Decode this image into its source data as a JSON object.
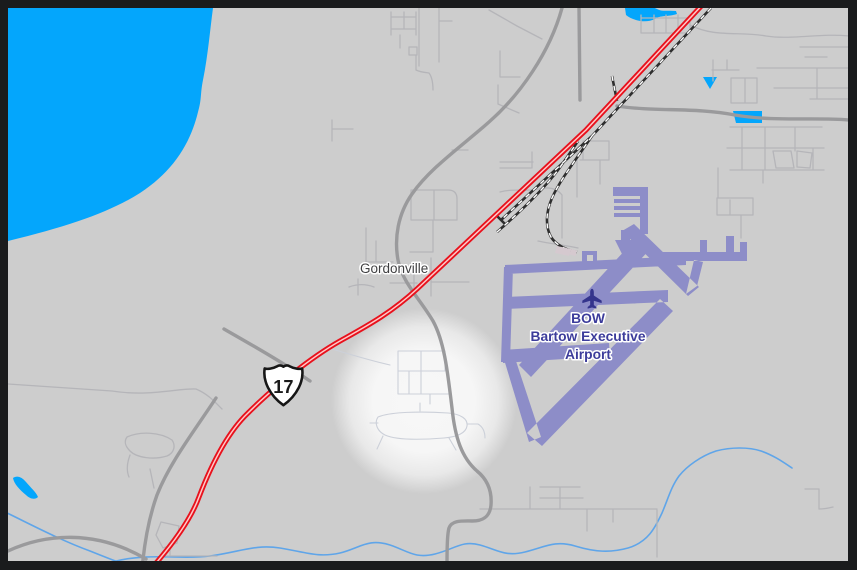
{
  "map": {
    "labels": {
      "town": "Gordonville",
      "airport_code": "BOW",
      "airport_name_line1": "Bartow Executive",
      "airport_name_line2": "Airport",
      "route_number": "17"
    },
    "colors": {
      "background": "#cdcdcd",
      "frame": "#1a1b1d",
      "water": "#04a6fc",
      "stream": "#5fa5e9",
      "street": "#b5b5b9",
      "street_faint": "#ccd0d9",
      "road": "#9a9a9c",
      "highway_red": "#e8111c",
      "highway_center": "#ffc9c9",
      "railway_dark": "#2e2e2e",
      "railway_dash": "#ffffff",
      "runway": "#8d8dc8",
      "airport_text": "#3c3c9b",
      "plane": "#34348c",
      "town_text": "#3f3f41",
      "building": "#d5c9cf",
      "shield_fill": "#ffffff",
      "shield_border": "#161616"
    }
  }
}
